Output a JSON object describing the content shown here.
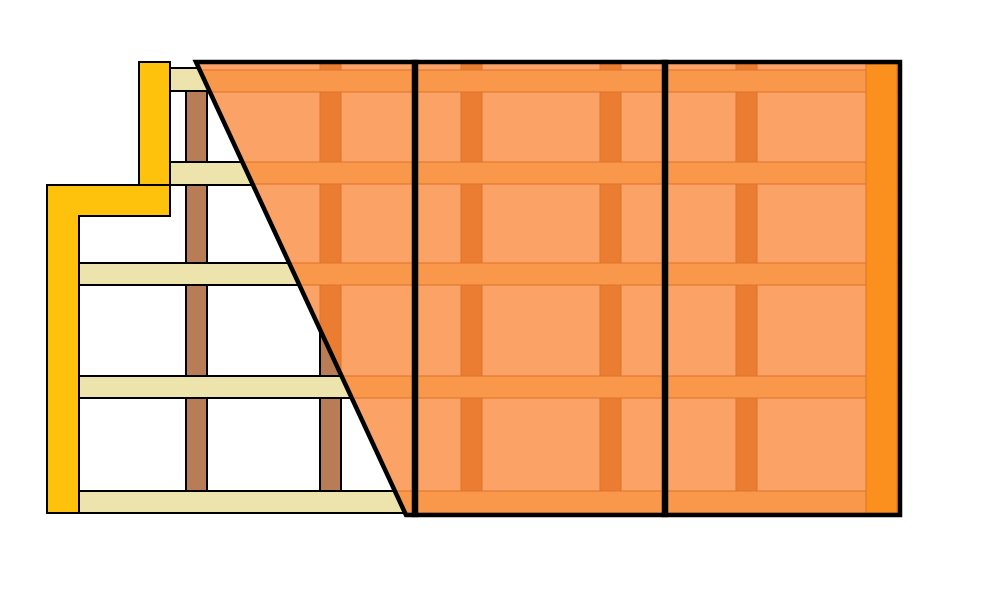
{
  "diagram": {
    "kind": "wall-framing-and-siding-installation-detail",
    "canvas": {
      "w": 996,
      "h": 604,
      "background": "#FFFFFF"
    },
    "colors": {
      "outline": "#000000",
      "trim_yellow": "#FEC20D",
      "girt_cream": "#EDE3AC",
      "stud_brown": "#B87C57",
      "panel_light": "#FBA366",
      "panel_band": "#F9974B",
      "panel_stripe": "#EB7D32",
      "panel_line": "#DD7329",
      "edge_strip": "#FC901E"
    },
    "strokes": {
      "framing": 2,
      "panel_border": 4.5,
      "panel_line": 1
    },
    "framing": {
      "studs": [
        {
          "name": "stud-1",
          "x": 186,
          "y": 90,
          "w": 21,
          "h": 401
        },
        {
          "name": "stud-2",
          "x": 320,
          "y": 90,
          "w": 21,
          "h": 401
        }
      ],
      "girts": [
        {
          "name": "girt-1",
          "x": 170,
          "y": 68,
          "w": 250,
          "h": 23
        },
        {
          "name": "girt-2",
          "x": 170,
          "y": 162,
          "w": 250,
          "h": 23
        },
        {
          "name": "girt-3",
          "x": 79,
          "y": 263,
          "w": 341,
          "h": 22
        },
        {
          "name": "girt-4",
          "x": 79,
          "y": 376,
          "w": 341,
          "h": 22
        },
        {
          "name": "girt-5",
          "x": 79,
          "y": 491,
          "w": 341,
          "h": 22
        }
      ],
      "corner_trim_head": {
        "name": "corner-trim-head",
        "x": 139,
        "y": 62,
        "w": 31,
        "h": 123
      },
      "corner_trim_step": {
        "name": "corner-trim-step",
        "points": "47,185 170,185 170,216 79,216 79,513 47,513"
      }
    },
    "siding": {
      "area": {
        "x0": 190,
        "y0": 60,
        "x1": 902,
        "y1": 519
      },
      "bands_y": [
        [
          70,
          92
        ],
        [
          162,
          184
        ],
        [
          263,
          285
        ],
        [
          376,
          398
        ],
        [
          491,
          513
        ]
      ],
      "stripes_x": [
        [
          320,
          341
        ],
        [
          461,
          482
        ],
        [
          600,
          621
        ],
        [
          736,
          757
        ]
      ],
      "stripe_span_y": [
        64,
        515
      ],
      "panels": [
        {
          "name": "siding-panel-1",
          "shape": "polygon",
          "points": "196,62 416,62 416,515 406,515"
        },
        {
          "name": "siding-panel-2",
          "shape": "rect",
          "x": 414,
          "y": 62,
          "w": 252,
          "h": 453
        },
        {
          "name": "siding-panel-3",
          "shape": "rect",
          "x": 664,
          "y": 62,
          "w": 236,
          "h": 453
        }
      ],
      "edge_strip": {
        "name": "siding-edge-strip",
        "x": 866,
        "y": 64,
        "w": 31,
        "h": 449
      }
    }
  }
}
